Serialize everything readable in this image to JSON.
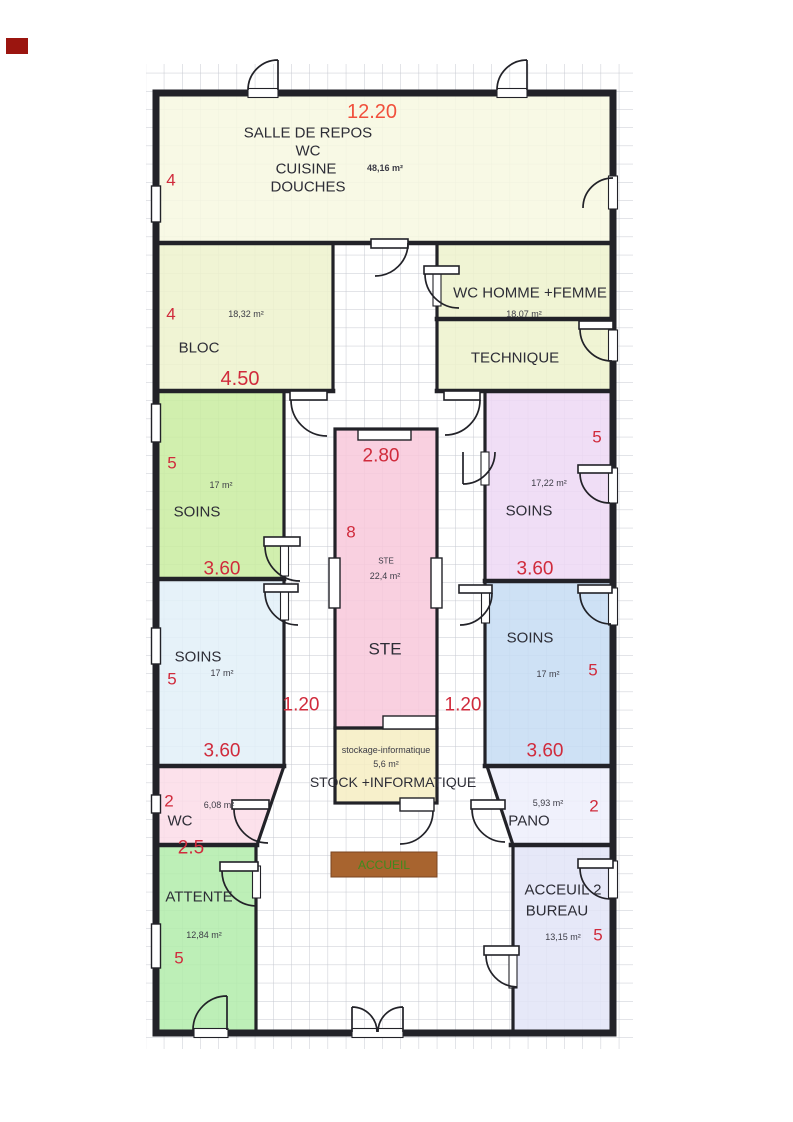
{
  "palette": {
    "wall": "#222228",
    "grid": "#c6c8d0",
    "dim_red": "#d02b3c",
    "dim_red_top": "#f1503c",
    "desk": "#a8642f",
    "desk_text": "#3f8a1e",
    "corner_mark": "#9b150f",
    "fills": {
      "salle": "#f7f8e0",
      "bloc": "#edf2cc",
      "wc_homme": "#edf2cc",
      "technique": "#edf2cc",
      "soins_nw": "#c9eca0",
      "soins_ne": "#edd8f5",
      "ste": "#f8c8db",
      "soins_sw": "#e2f0f8",
      "soins_se": "#c6dcf3",
      "stock": "#f6edc2",
      "wc": "#fbdce8",
      "pano": "#edeffb",
      "attente": "#b2ecaa",
      "acceuil2": "#e2e4f7"
    }
  },
  "rooms": {
    "salle_de_repos": {
      "line1": "SALLE DE REPOS",
      "line2": "WC",
      "line3": "CUISINE",
      "line4": "DOUCHES",
      "area": "48,16 m²",
      "dim_width": "12.20",
      "dim_height": "4"
    },
    "bloc": {
      "name": "BLOC",
      "area": "18,32 m²",
      "dim_height": "4",
      "dim_width": "4.50"
    },
    "wc_homme_femme": {
      "name": "WC HOMME +FEMME",
      "area": "18,07 m²"
    },
    "technique": {
      "name": "TECHNIQUE"
    },
    "soins_nw": {
      "name": "SOINS",
      "area": "17 m²",
      "dim_height": "5",
      "dim_width": "3.60"
    },
    "soins_ne": {
      "name": "SOINS",
      "area": "17,22 m²",
      "dim_height": "5",
      "dim_width": "3.60"
    },
    "ste": {
      "name": "STE",
      "sub_name": "STE",
      "area": "22,4 m²",
      "dim_width": "2.80",
      "dim_height": "8"
    },
    "soins_sw": {
      "name": "SOINS",
      "area": "17 m²",
      "dim_height": "5",
      "dim_width": "3.60"
    },
    "soins_se": {
      "name": "SOINS",
      "area": "17 m²",
      "dim_height": "5",
      "dim_width": "3.60"
    },
    "stock_informatique": {
      "label": "STOCK +INFORMATIQUE",
      "sub_label": "stockage-informatique",
      "area": "5,6 m²"
    },
    "wc": {
      "name": "WC",
      "area": "6,08 m²",
      "dim_height": "2",
      "dim_width": "2.5"
    },
    "pano": {
      "name": "PANO",
      "area": "5,93 m²",
      "dim_height": "2"
    },
    "attente": {
      "name": "ATTENTE",
      "area": "12,84 m²",
      "dim_height": "5"
    },
    "acceuil2": {
      "line1": "ACCEUIL 2",
      "line2": "BUREAU",
      "area": "13,15 m²",
      "dim_height": "5"
    },
    "accueil_desk": {
      "name": "ACCUEIL"
    }
  },
  "corridor": {
    "dim_left": "1.20",
    "dim_right": "1.20"
  }
}
